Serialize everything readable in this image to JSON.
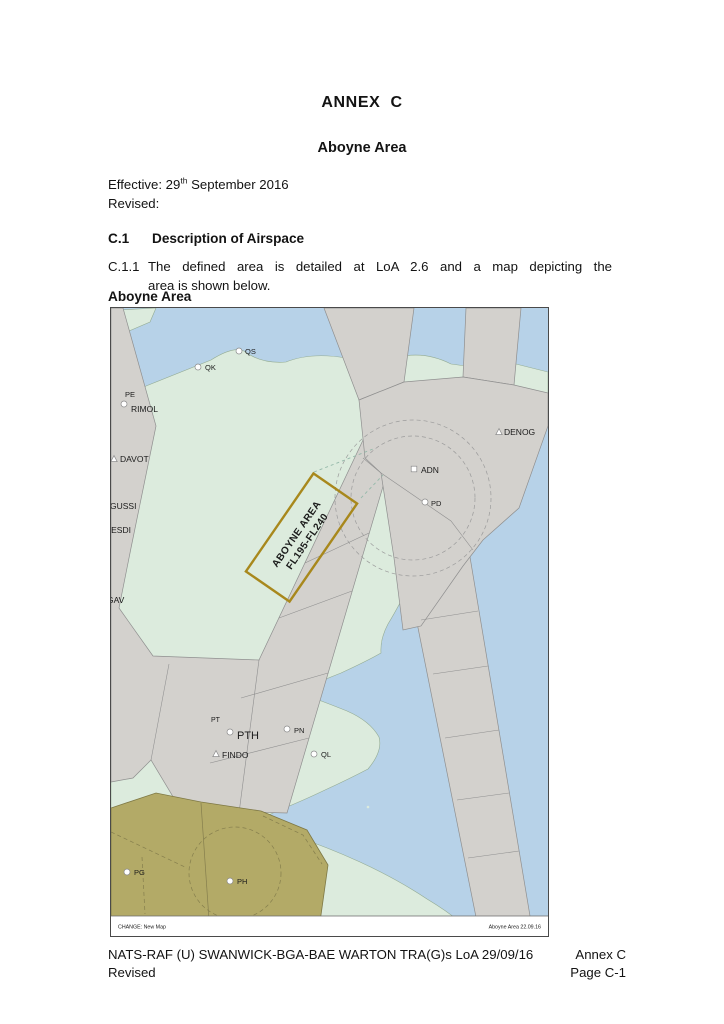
{
  "document": {
    "annex_heading": "ANNEX  C",
    "area_heading": "Aboyne Area",
    "effective_prefix": "Effective: 29",
    "effective_sup": "th",
    "effective_suffix": " September 2016",
    "revised_label": "Revised:",
    "section": {
      "number": "C.1",
      "title": "Description of Airspace"
    },
    "paragraph": {
      "number": "C.1.1",
      "line1": "The defined area is detailed at LoA 2.6 and a map depicting the",
      "line2": "area is shown below."
    },
    "map_caption": "Aboyne Area"
  },
  "map": {
    "aboyne_box": {
      "line1": "ABOYNE AREA",
      "line2": "FL195-FL240"
    },
    "change_note": "CHANGE: New Map",
    "ref_note": "Aboyne Area  22.09.16",
    "colors": {
      "water": "#b7d2e8",
      "land": "#dcebdd",
      "airway": "#d3d1cd",
      "military": "#b3aa67",
      "box_border": "#a8881c"
    },
    "labels": [
      {
        "text": "QS",
        "x": 134,
        "y": 46,
        "size": 7.5,
        "marker": "circle",
        "mx": 128,
        "my": 43
      },
      {
        "text": "QK",
        "x": 94,
        "y": 62,
        "size": 7.5,
        "marker": "circle",
        "mx": 87,
        "my": 59
      },
      {
        "text": "PE",
        "x": 14,
        "y": 89,
        "size": 7.5,
        "marker": "none"
      },
      {
        "text": "RIMOL",
        "x": 20,
        "y": 104,
        "size": 8.5,
        "marker": "circle",
        "mx": 13,
        "my": 96
      },
      {
        "text": "DAVOT",
        "x": 9,
        "y": 154,
        "size": 8.5,
        "marker": "triangle",
        "mx": 3,
        "my": 151
      },
      {
        "text": "GUSSI",
        "x": -1,
        "y": 201,
        "size": 8.5,
        "marker": "none"
      },
      {
        "text": "NESDI",
        "x": -6,
        "y": 225,
        "size": 8.5,
        "marker": "none"
      },
      {
        "text": "GAV",
        "x": -4,
        "y": 295,
        "size": 8.5,
        "marker": "none"
      },
      {
        "text": "DENOG",
        "x": 393,
        "y": 127,
        "size": 8.5,
        "marker": "triangle",
        "mx": 388,
        "my": 124
      },
      {
        "text": "ADN",
        "x": 310,
        "y": 165,
        "size": 8.5,
        "marker": "square",
        "mx": 303,
        "my": 161
      },
      {
        "text": "PD",
        "x": 320,
        "y": 198,
        "size": 7.5,
        "marker": "circle",
        "mx": 314,
        "my": 194
      },
      {
        "text": "PT",
        "x": 100,
        "y": 414,
        "size": 7,
        "marker": "circle",
        "mx": 119,
        "my": 424
      },
      {
        "text": "PTH",
        "x": 126,
        "y": 431,
        "size": 11,
        "marker": "none"
      },
      {
        "text": "PN",
        "x": 183,
        "y": 425,
        "size": 7.5,
        "marker": "circle",
        "mx": 176,
        "my": 421
      },
      {
        "text": "FINDO",
        "x": 111,
        "y": 450,
        "size": 8.5,
        "marker": "triangle",
        "mx": 105,
        "my": 446
      },
      {
        "text": "QL",
        "x": 210,
        "y": 449,
        "size": 7.5,
        "marker": "circle",
        "mx": 203,
        "my": 446
      },
      {
        "text": "PG",
        "x": 23,
        "y": 567,
        "size": 7.5,
        "marker": "circle",
        "mx": 16,
        "my": 564
      },
      {
        "text": "PH",
        "x": 126,
        "y": 576,
        "size": 7.5,
        "marker": "circle",
        "mx": 119,
        "my": 573
      }
    ]
  },
  "footer": {
    "line1_left": "NATS-RAF (U) SWANWICK-BGA-BAE WARTON TRA(G)s LoA 29/09/16",
    "line1_right": "Annex C",
    "line2_left": "Revised",
    "line2_right": "Page C-1"
  }
}
